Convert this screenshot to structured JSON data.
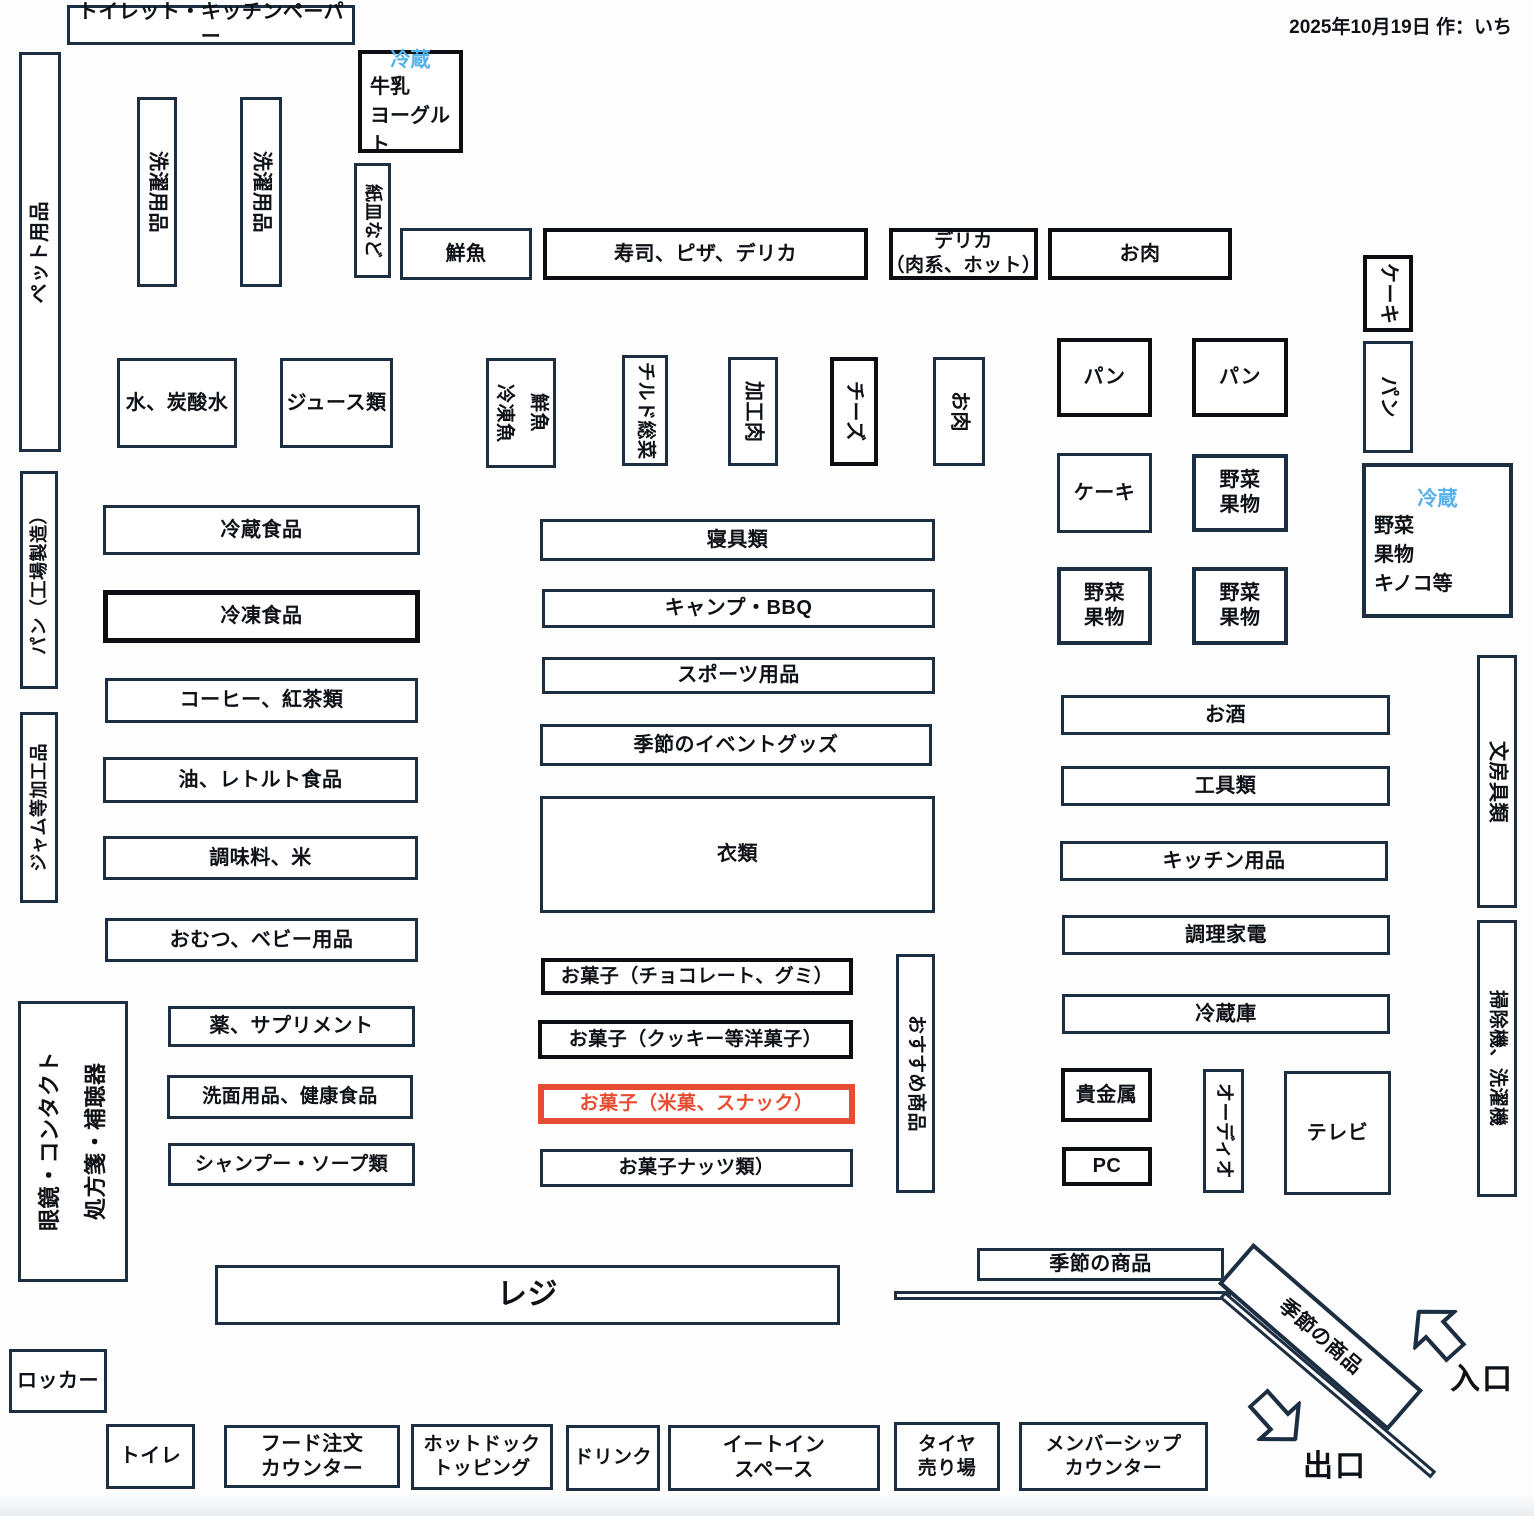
{
  "meta": {
    "date_note": "2025年10月19日 作：いち"
  },
  "palette": {
    "navy": "#1c2e41",
    "black": "#0c0e12",
    "red": "#e74c31",
    "blue": "#55b1e9",
    "ink": "#0e1116"
  },
  "arrows": {
    "entrance_label": "入口",
    "exit_label": "出口"
  },
  "boxes": [
    {
      "id": "zone-toilet-kitchen-paper",
      "label": "トイレット・キッチンペーパー",
      "x": 67,
      "y": 5,
      "w": 288,
      "h": 40
    },
    {
      "id": "zone-fridge-milk-yogurt",
      "fridge": "冷蔵",
      "lines": [
        "牛乳",
        "ヨーグルト"
      ],
      "x": 358,
      "y": 50,
      "w": 105,
      "h": 103,
      "bw": 4,
      "bc": "black"
    },
    {
      "id": "zone-pet-goods",
      "label": "ペット用品",
      "x": 19,
      "y": 52,
      "w": 42,
      "h": 400,
      "o": "ccw"
    },
    {
      "id": "zone-laundry-goods-1",
      "label": "洗濯用品",
      "x": 137,
      "y": 97,
      "w": 40,
      "h": 190,
      "o": "cw"
    },
    {
      "id": "zone-laundry-goods-2",
      "label": "洗濯用品",
      "x": 240,
      "y": 97,
      "w": 42,
      "h": 190,
      "o": "cw"
    },
    {
      "id": "zone-paper-plates",
      "label": "紙皿など",
      "x": 354,
      "y": 163,
      "w": 37,
      "h": 115,
      "o": "cw",
      "fs": 18
    },
    {
      "id": "zone-fresh-fish",
      "label": "鮮魚",
      "x": 400,
      "y": 228,
      "w": 132,
      "h": 52
    },
    {
      "id": "zone-sushi-pizza-deli",
      "label": "寿司、ピザ、デリカ",
      "x": 543,
      "y": 228,
      "w": 325,
      "h": 52,
      "bw": 4,
      "bc": "black"
    },
    {
      "id": "zone-deli-meat-hot",
      "lines": [
        "デリカ",
        "（肉系、ホット）"
      ],
      "x": 889,
      "y": 228,
      "w": 149,
      "h": 52,
      "bw": 4,
      "bc": "black",
      "fs": 19
    },
    {
      "id": "zone-meat-top",
      "label": "お肉",
      "x": 1048,
      "y": 228,
      "w": 184,
      "h": 52,
      "bw": 4,
      "bc": "black"
    },
    {
      "id": "zone-cake-vertical",
      "label": "ケーキ",
      "x": 1363,
      "y": 255,
      "w": 50,
      "h": 77,
      "o": "cw",
      "bw": 4,
      "bc": "black"
    },
    {
      "id": "zone-bread-vertical",
      "label": "パン",
      "x": 1363,
      "y": 341,
      "w": 50,
      "h": 112,
      "o": "cw"
    },
    {
      "id": "zone-water-soda",
      "label": "水、炭酸水",
      "x": 117,
      "y": 358,
      "w": 120,
      "h": 90
    },
    {
      "id": "zone-juice",
      "label": "ジュース類",
      "x": 280,
      "y": 358,
      "w": 113,
      "h": 90
    },
    {
      "id": "zone-fish-frozen-fish",
      "lines": [
        "鮮魚",
        "冷凍魚"
      ],
      "x": 486,
      "y": 358,
      "w": 70,
      "h": 110,
      "o": "cw",
      "fs": 19,
      "lh": "1.8"
    },
    {
      "id": "zone-chilled-sozai",
      "label": "チルド総菜",
      "x": 622,
      "y": 355,
      "w": 46,
      "h": 111,
      "o": "cw",
      "fs": 19
    },
    {
      "id": "zone-processed-meat",
      "label": "加工肉",
      "x": 728,
      "y": 357,
      "w": 50,
      "h": 109,
      "o": "cw"
    },
    {
      "id": "zone-cheese",
      "label": "チーズ",
      "x": 830,
      "y": 357,
      "w": 48,
      "h": 109,
      "o": "cw",
      "bw": 4,
      "bc": "black"
    },
    {
      "id": "zone-meat-vertical",
      "label": "お肉",
      "x": 933,
      "y": 357,
      "w": 52,
      "h": 109,
      "o": "cw"
    },
    {
      "id": "zone-bread-1",
      "label": "パン",
      "x": 1057,
      "y": 338,
      "w": 95,
      "h": 79,
      "bw": 4,
      "bc": "black"
    },
    {
      "id": "zone-bread-2",
      "label": "パン",
      "x": 1192,
      "y": 338,
      "w": 96,
      "h": 79,
      "bw": 4,
      "bc": "black"
    },
    {
      "id": "zone-cake-1",
      "label": "ケーキ",
      "x": 1057,
      "y": 453,
      "w": 95,
      "h": 80
    },
    {
      "id": "zone-veg-fruit-1",
      "lines": [
        "野菜",
        "果物"
      ],
      "x": 1192,
      "y": 454,
      "w": 96,
      "h": 78,
      "bw": 4
    },
    {
      "id": "zone-fridge-veg-fruit",
      "fridge": "冷蔵",
      "lines": [
        "野菜",
        "果物",
        "キノコ等"
      ],
      "x": 1362,
      "y": 463,
      "w": 151,
      "h": 155,
      "bw": 4
    },
    {
      "id": "zone-veg-fruit-2",
      "lines": [
        "野菜",
        "果物"
      ],
      "x": 1057,
      "y": 567,
      "w": 95,
      "h": 78,
      "bw": 4
    },
    {
      "id": "zone-veg-fruit-3",
      "lines": [
        "野菜",
        "果物"
      ],
      "x": 1192,
      "y": 567,
      "w": 96,
      "h": 78,
      "bw": 4
    },
    {
      "id": "zone-bread-factory",
      "label": "パン（工場製造）",
      "x": 20,
      "y": 471,
      "w": 38,
      "h": 218,
      "o": "ccw",
      "fs": 18
    },
    {
      "id": "zone-jam-processed",
      "label": "ジャム等加工品",
      "x": 20,
      "y": 712,
      "w": 38,
      "h": 191,
      "o": "ccw",
      "fs": 18
    },
    {
      "id": "zone-chilled-food",
      "label": "冷蔵食品",
      "x": 103,
      "y": 505,
      "w": 317,
      "h": 50
    },
    {
      "id": "zone-frozen-food",
      "label": "冷凍食品",
      "x": 103,
      "y": 590,
      "w": 317,
      "h": 53,
      "bw": 5,
      "bc": "black"
    },
    {
      "id": "zone-coffee-tea",
      "label": "コーヒー、紅茶類",
      "x": 105,
      "y": 678,
      "w": 313,
      "h": 45
    },
    {
      "id": "zone-oil-retort",
      "label": "油、レトルト食品",
      "x": 103,
      "y": 757,
      "w": 315,
      "h": 46
    },
    {
      "id": "zone-seasoning-rice",
      "label": "調味料、米",
      "x": 103,
      "y": 836,
      "w": 315,
      "h": 44
    },
    {
      "id": "zone-diaper-baby",
      "label": "おむつ、ベビー用品",
      "x": 105,
      "y": 918,
      "w": 313,
      "h": 44
    },
    {
      "id": "zone-bedding",
      "label": "寝具類",
      "x": 540,
      "y": 519,
      "w": 395,
      "h": 42
    },
    {
      "id": "zone-camp-bbq",
      "label": "キャンプ・BBQ",
      "x": 542,
      "y": 589,
      "w": 393,
      "h": 39
    },
    {
      "id": "zone-sports",
      "label": "スポーツ用品",
      "x": 542,
      "y": 657,
      "w": 393,
      "h": 37
    },
    {
      "id": "zone-seasonal-event",
      "label": "季節のイベントグッズ",
      "x": 540,
      "y": 724,
      "w": 392,
      "h": 42
    },
    {
      "id": "zone-clothing",
      "label": "衣類",
      "x": 540,
      "y": 796,
      "w": 395,
      "h": 117
    },
    {
      "id": "zone-sake",
      "label": "お酒",
      "x": 1061,
      "y": 695,
      "w": 329,
      "h": 40
    },
    {
      "id": "zone-tools",
      "label": "工具類",
      "x": 1061,
      "y": 766,
      "w": 329,
      "h": 40
    },
    {
      "id": "zone-kitchen-goods",
      "label": "キッチン用品",
      "x": 1060,
      "y": 841,
      "w": 328,
      "h": 40
    },
    {
      "id": "zone-cooking-appliance",
      "label": "調理家電",
      "x": 1062,
      "y": 915,
      "w": 328,
      "h": 40
    },
    {
      "id": "zone-refrigerators",
      "label": "冷蔵庫",
      "x": 1062,
      "y": 994,
      "w": 328,
      "h": 40
    },
    {
      "id": "zone-stationery",
      "label": "文房具類",
      "x": 1477,
      "y": 655,
      "w": 40,
      "h": 253,
      "o": "cw"
    },
    {
      "id": "zone-vacuum-washer",
      "label": "掃除機、洗濯機",
      "x": 1477,
      "y": 920,
      "w": 40,
      "h": 277,
      "o": "cw",
      "fs": 19
    },
    {
      "id": "zone-medicine-supplement",
      "label": "薬、サプリメント",
      "x": 168,
      "y": 1006,
      "w": 247,
      "h": 41
    },
    {
      "id": "zone-toiletries-health",
      "label": "洗面用品、健康食品",
      "x": 167,
      "y": 1075,
      "w": 246,
      "h": 44,
      "fs": 19
    },
    {
      "id": "zone-shampoo-soap",
      "label": "シャンプー・ソープ類",
      "x": 168,
      "y": 1143,
      "w": 247,
      "h": 43,
      "fs": 19
    },
    {
      "id": "zone-glasses-pharmacy",
      "lines": [
        "眼鏡・コンタクト",
        "処方箋・補聴器"
      ],
      "x": 18,
      "y": 1001,
      "w": 110,
      "h": 281,
      "o": "ccw",
      "fs": 22,
      "lh": "2.1"
    },
    {
      "id": "zone-sweets-choco-gummy",
      "label": "お菓子（チョコレート、グミ）",
      "x": 541,
      "y": 958,
      "w": 312,
      "h": 37,
      "bw": 4,
      "bc": "black",
      "fs": 19
    },
    {
      "id": "zone-sweets-cookie",
      "label": "お菓子（クッキー等洋菓子）",
      "x": 538,
      "y": 1020,
      "w": 315,
      "h": 39,
      "bw": 4,
      "bc": "black",
      "fs": 19
    },
    {
      "id": "zone-sweets-rice-snack",
      "label": "お菓子（米菓、スナック）",
      "x": 538,
      "y": 1084,
      "w": 317,
      "h": 40,
      "bw": 6,
      "bc": "red",
      "color": "red",
      "fs": 19
    },
    {
      "id": "zone-sweets-nuts",
      "label": "お菓子ナッツ類）",
      "x": 540,
      "y": 1149,
      "w": 313,
      "h": 38,
      "fs": 19
    },
    {
      "id": "zone-recommended",
      "label": "おすすめ商品",
      "x": 896,
      "y": 954,
      "w": 39,
      "h": 239,
      "o": "cw",
      "fs": 19
    },
    {
      "id": "zone-precious-metal",
      "label": "貴金属",
      "x": 1061,
      "y": 1068,
      "w": 91,
      "h": 54,
      "bw": 4,
      "bc": "black"
    },
    {
      "id": "zone-pc",
      "label": "PC",
      "x": 1062,
      "y": 1147,
      "w": 90,
      "h": 39,
      "bw": 4,
      "bc": "black"
    },
    {
      "id": "zone-audio",
      "label": "オーディオ",
      "x": 1203,
      "y": 1069,
      "w": 41,
      "h": 124,
      "o": "cw",
      "fs": 19
    },
    {
      "id": "zone-tv",
      "label": "テレビ",
      "x": 1284,
      "y": 1071,
      "w": 107,
      "h": 124
    },
    {
      "id": "zone-seasonal-items",
      "label": "季節の商品",
      "x": 977,
      "y": 1248,
      "w": 247,
      "h": 33
    },
    {
      "id": "zone-seasonal-items-diagonal",
      "label": "季節の商品",
      "x": 1208,
      "y": 1310,
      "w": 225,
      "h": 54,
      "rot": 41,
      "bw": 4
    },
    {
      "id": "zone-register",
      "label": "レジ",
      "x": 215,
      "y": 1265,
      "w": 625,
      "h": 60,
      "fs": 30
    },
    {
      "id": "zone-locker",
      "label": "ロッカー",
      "x": 9,
      "y": 1349,
      "w": 98,
      "h": 64
    },
    {
      "id": "zone-toilet",
      "label": "トイレ",
      "x": 106,
      "y": 1424,
      "w": 89,
      "h": 65
    },
    {
      "id": "zone-food-order-counter",
      "lines": [
        "フード注文",
        "カウンター"
      ],
      "x": 224,
      "y": 1425,
      "w": 176,
      "h": 63
    },
    {
      "id": "zone-hotdog-topping",
      "lines": [
        "ホットドック",
        "トッピング"
      ],
      "x": 411,
      "y": 1424,
      "w": 142,
      "h": 66,
      "fs": 19
    },
    {
      "id": "zone-drink",
      "label": "ドリンク",
      "x": 566,
      "y": 1425,
      "w": 94,
      "h": 66,
      "fs": 19
    },
    {
      "id": "zone-eat-in-space",
      "lines": [
        "イートイン",
        "スペース"
      ],
      "x": 668,
      "y": 1425,
      "w": 212,
      "h": 66
    },
    {
      "id": "zone-tire",
      "lines": [
        "タイヤ",
        "売り場"
      ],
      "x": 894,
      "y": 1422,
      "w": 106,
      "h": 69,
      "fs": 19
    },
    {
      "id": "zone-membership-counter",
      "lines": [
        "メンバーシップ",
        "カウンター"
      ],
      "x": 1019,
      "y": 1422,
      "w": 189,
      "h": 69,
      "fs": 19
    }
  ],
  "walls": [
    {
      "id": "wall-horizontal",
      "x": 894,
      "y": 1291,
      "w": 337,
      "h": 9,
      "rot": 0
    },
    {
      "id": "wall-diagonal",
      "x": 1222,
      "y": 1290,
      "w": 278,
      "h": 9,
      "rot": 40.5
    }
  ]
}
